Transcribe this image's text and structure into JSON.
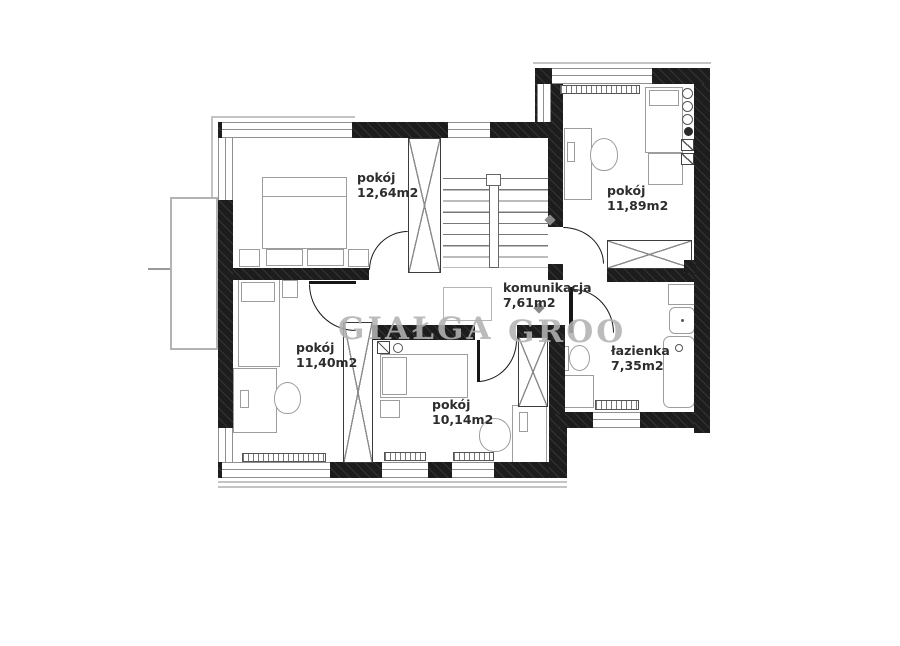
{
  "plan": {
    "rooms": [
      {
        "name": "pokój",
        "area": "12,64m2"
      },
      {
        "name": "pokój",
        "area": "11,89m2"
      },
      {
        "name": "komunikacja",
        "area": "7,61m2"
      },
      {
        "name": "pokój",
        "area": "11,40m2"
      },
      {
        "name": "pokój",
        "area": "10,14m2"
      },
      {
        "name": "łazienka",
        "area": "7,35m2"
      }
    ],
    "watermark_fragments": [
      "GIAŁGA",
      "GROO"
    ],
    "colors": {
      "wall": "#1d1d1d",
      "window_line": "#8f8f8f",
      "furniture_outline": "#9d9d9d",
      "label_text": "#2d2d2d",
      "watermark": "#b2b2b2"
    }
  }
}
